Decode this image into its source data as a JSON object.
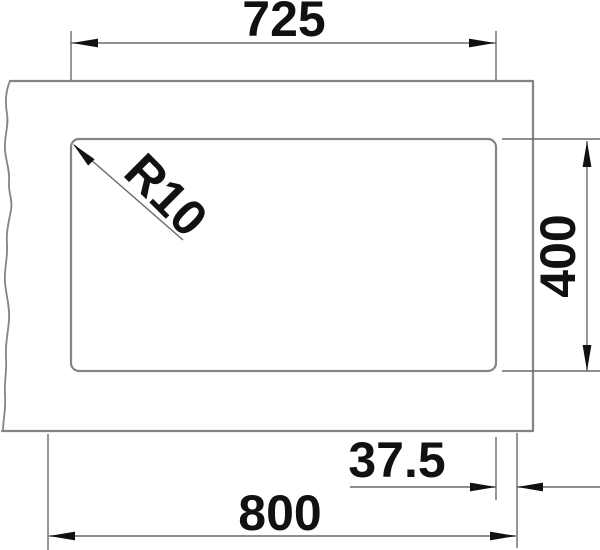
{
  "colors": {
    "background": "#ffffff",
    "shape-line": "#848484",
    "dimension-line": "#6a6a6a",
    "ink": "#111111"
  },
  "dimensions": {
    "bowl_width": {
      "label": "725"
    },
    "corner_radius": {
      "label": "R10"
    },
    "bowl_depth": {
      "label": "400"
    },
    "side_offset": {
      "label": "37.5"
    },
    "overall_width": {
      "label": "800"
    }
  }
}
